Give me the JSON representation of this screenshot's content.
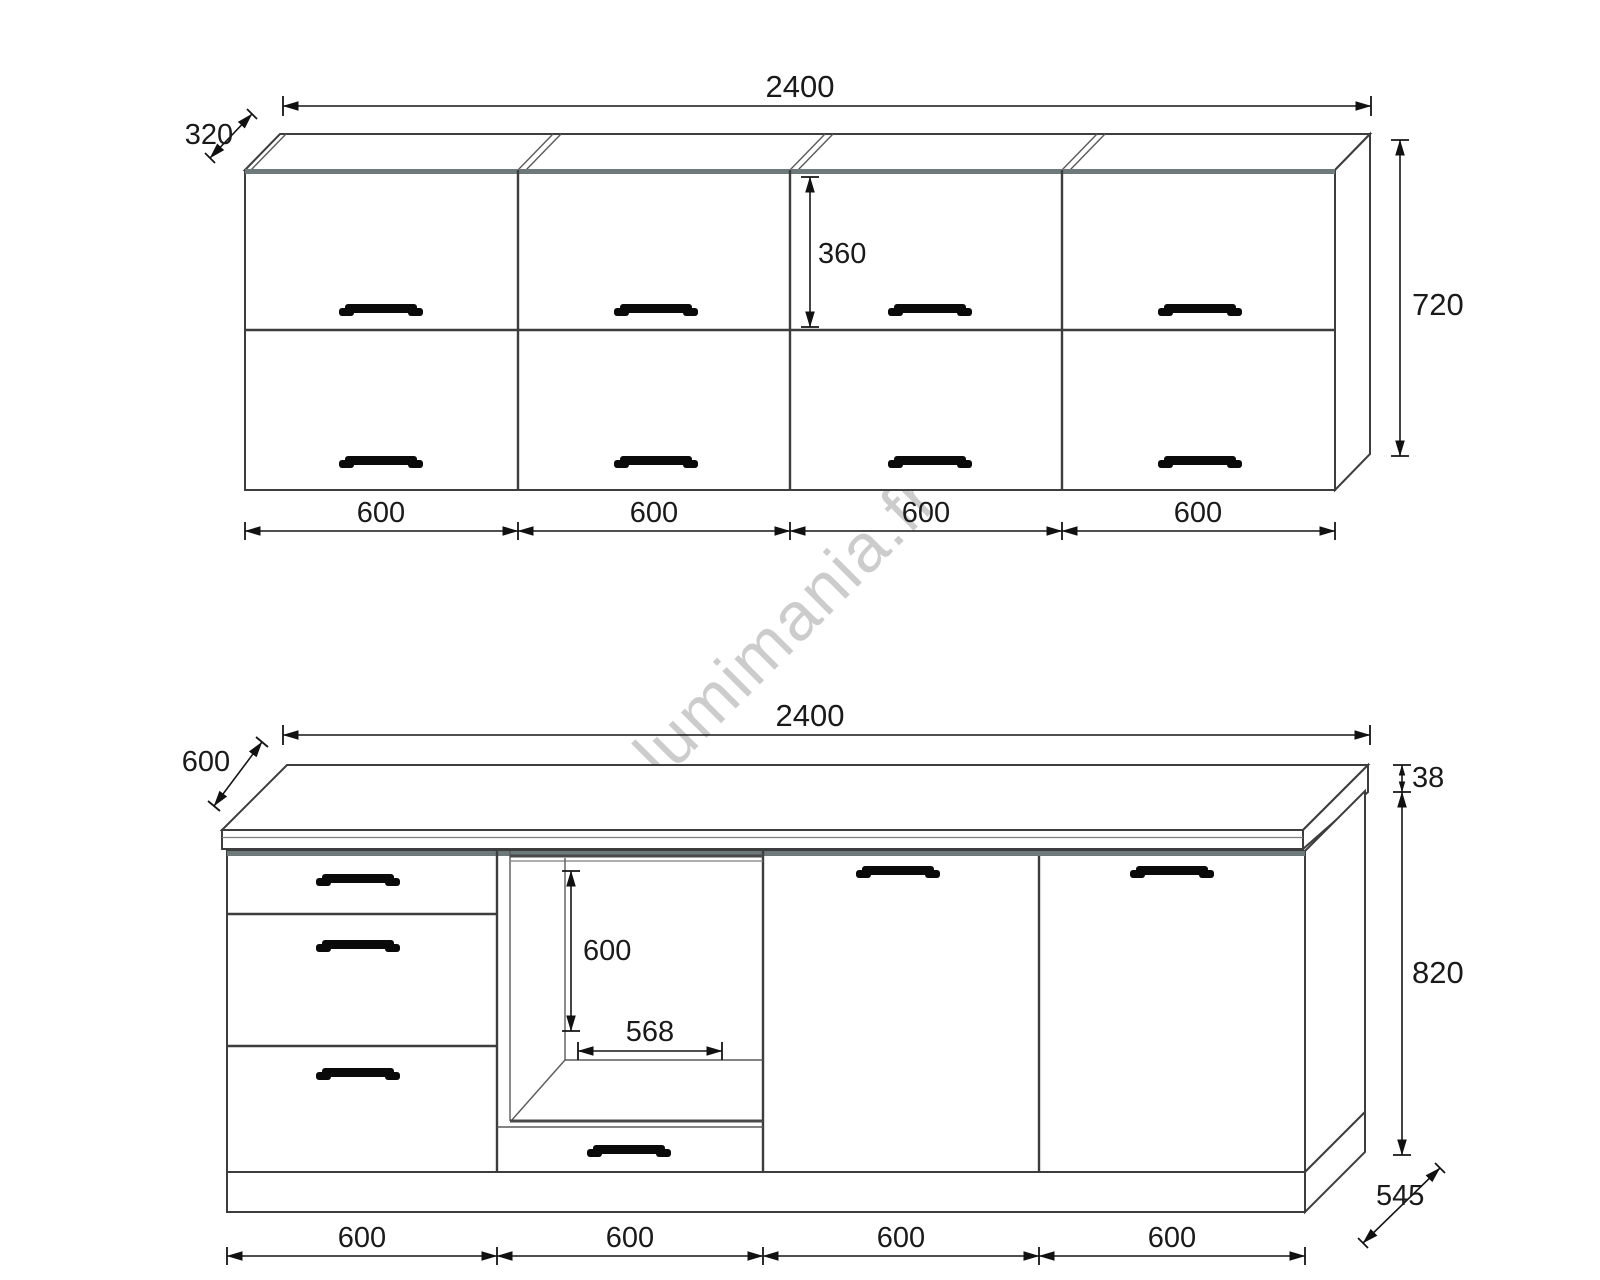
{
  "watermark": {
    "text": "lumimania.fr",
    "color": "#c7c7c7"
  },
  "wall": {
    "title": "wall cabinet elevation",
    "width": "2400",
    "depth": "320",
    "door_height": "360",
    "height": "720",
    "sections": [
      "600",
      "600",
      "600",
      "600"
    ]
  },
  "base": {
    "title": "base cabinet elevation",
    "width": "2400",
    "depth": "600",
    "top_thickness": "38",
    "niche_height": "600",
    "niche_width": "568",
    "height": "820",
    "side_depth": "545",
    "sections": [
      "600",
      "600",
      "600",
      "600"
    ]
  }
}
